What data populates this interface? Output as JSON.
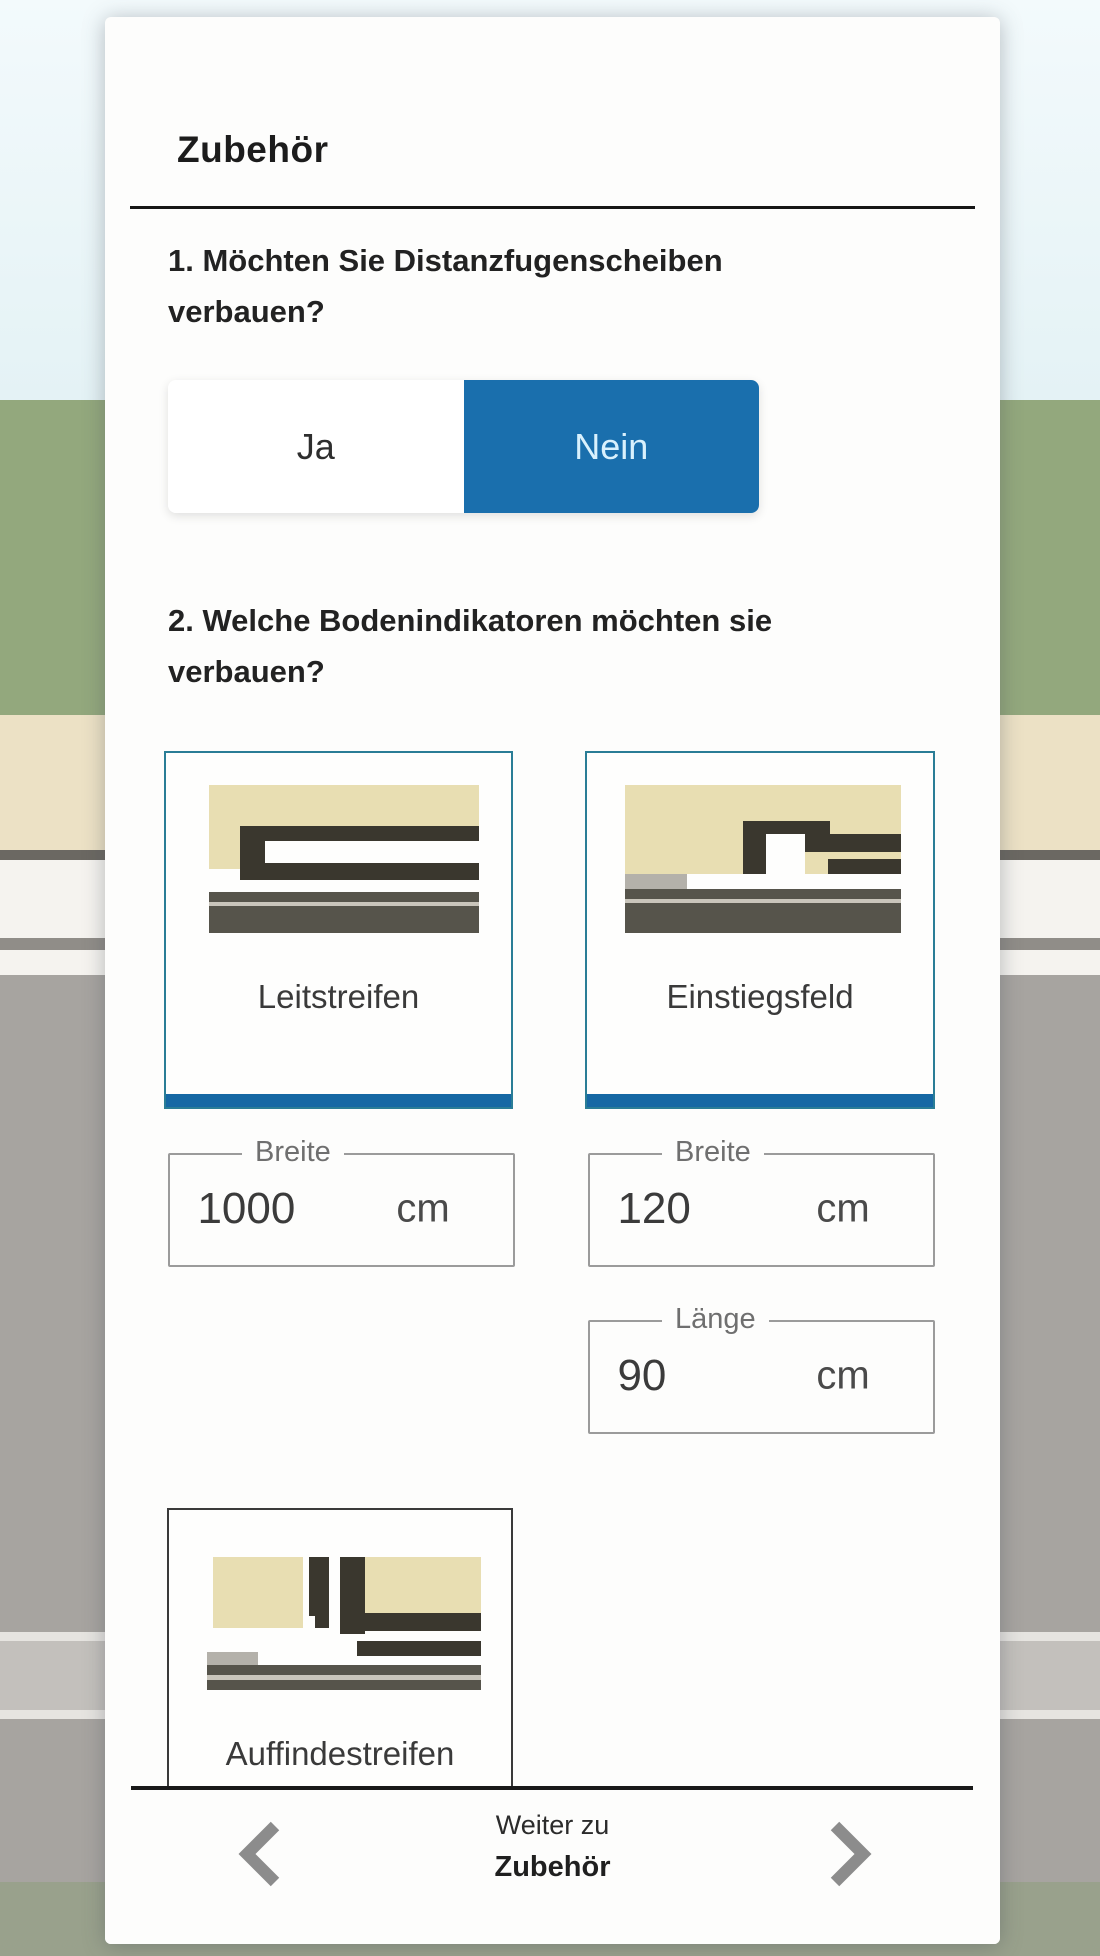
{
  "panel": {
    "title": "Zubehör",
    "questions": [
      {
        "text": "1. Möchten Sie Distanzfugenscheiben verbauen?",
        "options": [
          {
            "label": "Ja",
            "selected": false
          },
          {
            "label": "Nein",
            "selected": true
          }
        ]
      },
      {
        "text": "2. Welche Bodenindikatoren möchten sie verbauen?",
        "cards": [
          {
            "label": "Leitstreifen",
            "selected": true,
            "icon": "leitstreifen-profile-illustration"
          },
          {
            "label": "Einstiegsfeld",
            "selected": true,
            "icon": "einstiegsfeld-profile-illustration"
          },
          {
            "label": "Auffindestreifen",
            "selected": false,
            "icon": "auffindestreifen-profile-illustration"
          }
        ],
        "fields": [
          {
            "label": "Breite",
            "value": "1000",
            "unit": "cm"
          },
          {
            "label": "Breite",
            "value": "120",
            "unit": "cm"
          },
          {
            "label": "Länge",
            "value": "90",
            "unit": "cm"
          }
        ]
      }
    ],
    "bottom_nav": {
      "prefix": "Weiter zu",
      "target": "Zubehör",
      "prev_icon": "chevron-left",
      "next_icon": "chevron-right"
    }
  },
  "colors": {
    "accent_blue": "#1a6fad",
    "card_selected_border": "#2a7d96",
    "card_selected_bar": "#1668a4",
    "panel_background": "#fdfdfc"
  }
}
